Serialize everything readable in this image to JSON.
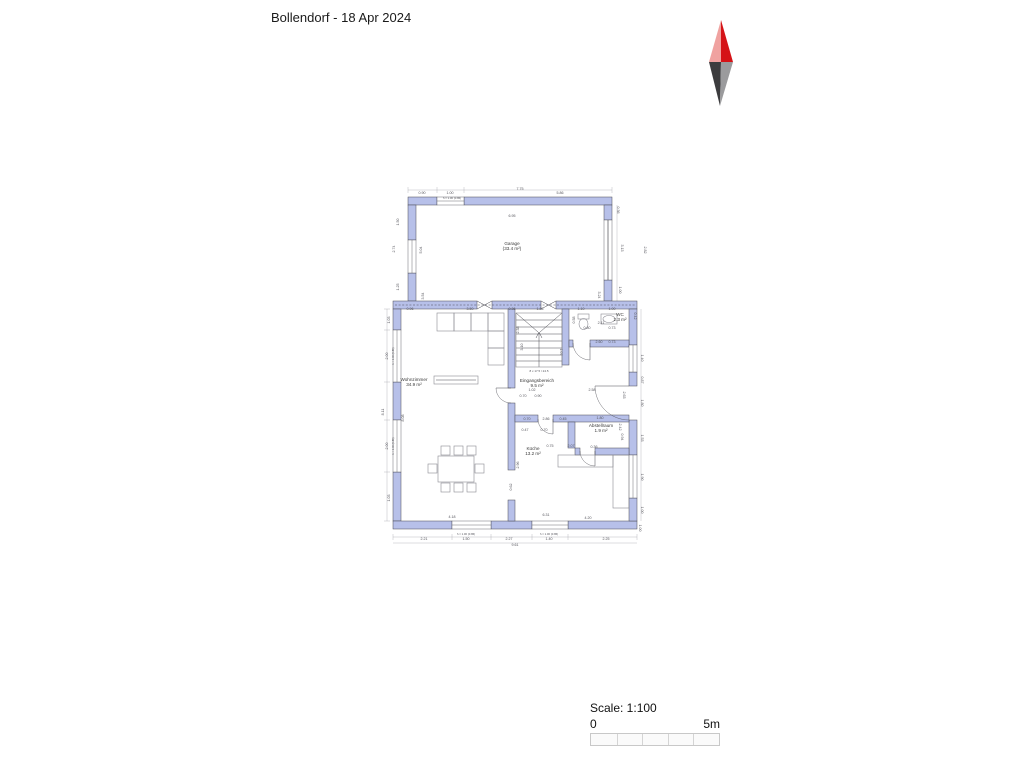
{
  "title": "Bollendorf - 18 Apr 2024",
  "scale": {
    "label": "Scale: 1:100",
    "start": "0",
    "end": "5m",
    "divisions": 5
  },
  "north_arrow": {
    "colors": {
      "nw": "#f0a2a0",
      "ne": "#d51317",
      "sw": "#3c3c3e",
      "se": "#9b9b9d"
    },
    "points": {
      "nw": "721,20 709,62 721,62",
      "ne": "721,20 733,62 721,62",
      "sw": "709,62 721,62 720,106",
      "se": "733,62 721,62 720,106"
    }
  },
  "colors": {
    "wall": "#b7c0e9",
    "outline": "#4a4a52",
    "dim": "#55555c",
    "guide": "#a8a8b0",
    "furniture": "#8a8a92"
  },
  "plan": {
    "walls": [
      {
        "x": 408,
        "y": 197,
        "w": 29,
        "h": 8
      },
      {
        "x": 464,
        "y": 197,
        "w": 148,
        "h": 8
      },
      {
        "x": 408,
        "y": 205,
        "w": 8,
        "h": 35
      },
      {
        "x": 408,
        "y": 273,
        "w": 8,
        "h": 28
      },
      {
        "x": 604,
        "y": 205,
        "w": 8,
        "h": 15
      },
      {
        "x": 604,
        "y": 280,
        "w": 8,
        "h": 21
      },
      {
        "x": 393,
        "y": 301,
        "w": 84,
        "h": 8
      },
      {
        "x": 492,
        "y": 301,
        "w": 49,
        "h": 8
      },
      {
        "x": 556,
        "y": 301,
        "w": 81,
        "h": 8
      },
      {
        "x": 393,
        "y": 309,
        "w": 8,
        "h": 21
      },
      {
        "x": 393,
        "y": 382,
        "w": 8,
        "h": 38
      },
      {
        "x": 393,
        "y": 472,
        "w": 8,
        "h": 49
      },
      {
        "x": 393,
        "y": 521,
        "w": 59,
        "h": 8
      },
      {
        "x": 491,
        "y": 521,
        "w": 41,
        "h": 8
      },
      {
        "x": 568,
        "y": 521,
        "w": 69,
        "h": 8
      },
      {
        "x": 629,
        "y": 309,
        "w": 8,
        "h": 36
      },
      {
        "x": 629,
        "y": 372,
        "w": 8,
        "h": 14
      },
      {
        "x": 629,
        "y": 420,
        "w": 8,
        "h": 35
      },
      {
        "x": 629,
        "y": 498,
        "w": 8,
        "h": 23
      },
      {
        "x": 508,
        "y": 309,
        "w": 7,
        "h": 79
      },
      {
        "x": 508,
        "y": 403,
        "w": 7,
        "h": 67
      },
      {
        "x": 508,
        "y": 500,
        "w": 7,
        "h": 21
      },
      {
        "x": 562,
        "y": 309,
        "w": 7,
        "h": 56
      },
      {
        "x": 569,
        "y": 340,
        "w": 4,
        "h": 7
      },
      {
        "x": 590,
        "y": 340,
        "w": 39,
        "h": 7
      },
      {
        "x": 515,
        "y": 415,
        "w": 23,
        "h": 7
      },
      {
        "x": 553,
        "y": 415,
        "w": 76,
        "h": 7
      },
      {
        "x": 568,
        "y": 422,
        "w": 7,
        "h": 26
      },
      {
        "x": 575,
        "y": 448,
        "w": 5,
        "h": 7
      },
      {
        "x": 595,
        "y": 448,
        "w": 34,
        "h": 7
      }
    ],
    "windows": [
      {
        "x": 437,
        "y": 197,
        "w": 27,
        "h": 8,
        "o": "h"
      },
      {
        "x": 408,
        "y": 240,
        "w": 8,
        "h": 33,
        "o": "v"
      },
      {
        "x": 604,
        "y": 220,
        "w": 8,
        "h": 60,
        "o": "v"
      },
      {
        "x": 393,
        "y": 330,
        "w": 8,
        "h": 52,
        "o": "v"
      },
      {
        "x": 393,
        "y": 420,
        "w": 8,
        "h": 52,
        "o": "v"
      },
      {
        "x": 629,
        "y": 345,
        "w": 8,
        "h": 27,
        "o": "v"
      },
      {
        "x": 629,
        "y": 455,
        "w": 8,
        "h": 43,
        "o": "v"
      },
      {
        "x": 452,
        "y": 521,
        "w": 39,
        "h": 8,
        "o": "h"
      },
      {
        "x": 532,
        "y": 521,
        "w": 36,
        "h": 8,
        "o": "h"
      }
    ],
    "lines": [
      {
        "x1": 477,
        "y1": 301,
        "x2": 492,
        "y2": 309
      },
      {
        "x1": 477,
        "y1": 309,
        "x2": 492,
        "y2": 301
      },
      {
        "x1": 541,
        "y1": 301,
        "x2": 556,
        "y2": 309
      },
      {
        "x1": 541,
        "y1": 309,
        "x2": 556,
        "y2": 301
      },
      {
        "x1": 395,
        "y1": 305,
        "x2": 635,
        "y2": 305,
        "dash": 1
      },
      {
        "x1": 608,
        "y1": 220,
        "x2": 608,
        "y2": 280
      },
      {
        "x1": 436,
        "y1": 380,
        "x2": 476,
        "y2": 380
      },
      {
        "x1": 516,
        "y1": 320,
        "x2": 562,
        "y2": 320
      },
      {
        "x1": 516,
        "y1": 327,
        "x2": 562,
        "y2": 327
      },
      {
        "x1": 516,
        "y1": 334,
        "x2": 562,
        "y2": 334
      },
      {
        "x1": 516,
        "y1": 341,
        "x2": 562,
        "y2": 341
      },
      {
        "x1": 516,
        "y1": 348,
        "x2": 562,
        "y2": 348
      },
      {
        "x1": 516,
        "y1": 355,
        "x2": 562,
        "y2": 355
      },
      {
        "x1": 516,
        "y1": 361,
        "x2": 562,
        "y2": 361
      },
      {
        "x1": 516,
        "y1": 313,
        "x2": 538,
        "y2": 332
      },
      {
        "x1": 562,
        "y1": 313,
        "x2": 540,
        "y2": 332
      },
      {
        "x1": 539,
        "y1": 367,
        "x2": 539,
        "y2": 332
      },
      {
        "x1": 536,
        "y1": 338,
        "x2": 539,
        "y2": 332
      },
      {
        "x1": 542,
        "y1": 338,
        "x2": 539,
        "y2": 332
      },
      {
        "x1": 629,
        "y1": 386,
        "x2": 595,
        "y2": 386
      },
      {
        "x1": 511,
        "y1": 388,
        "x2": 496,
        "y2": 388
      },
      {
        "x1": 590,
        "y1": 343,
        "x2": 590,
        "y2": 360
      },
      {
        "x1": 553,
        "y1": 419,
        "x2": 553,
        "y2": 434
      },
      {
        "x1": 595,
        "y1": 451,
        "x2": 595,
        "y2": 466
      }
    ],
    "guides": [
      {
        "x1": 408,
        "y1": 190,
        "x2": 612,
        "y2": 190
      },
      {
        "x1": 393,
        "y1": 537,
        "x2": 637,
        "y2": 537
      },
      {
        "x1": 393,
        "y1": 543,
        "x2": 637,
        "y2": 543
      },
      {
        "x1": 387,
        "y1": 309,
        "x2": 387,
        "y2": 521
      },
      {
        "x1": 617,
        "y1": 205,
        "x2": 617,
        "y2": 301
      },
      {
        "x1": 641,
        "y1": 309,
        "x2": 641,
        "y2": 521
      },
      {
        "x1": 408,
        "y1": 187,
        "x2": 408,
        "y2": 193
      },
      {
        "x1": 437,
        "y1": 187,
        "x2": 437,
        "y2": 193
      },
      {
        "x1": 464,
        "y1": 187,
        "x2": 464,
        "y2": 193
      },
      {
        "x1": 612,
        "y1": 187,
        "x2": 612,
        "y2": 193
      },
      {
        "x1": 393,
        "y1": 534,
        "x2": 393,
        "y2": 540
      },
      {
        "x1": 452,
        "y1": 534,
        "x2": 452,
        "y2": 540
      },
      {
        "x1": 491,
        "y1": 534,
        "x2": 491,
        "y2": 540
      },
      {
        "x1": 532,
        "y1": 534,
        "x2": 532,
        "y2": 540
      },
      {
        "x1": 568,
        "y1": 534,
        "x2": 568,
        "y2": 540
      },
      {
        "x1": 637,
        "y1": 534,
        "x2": 637,
        "y2": 540
      },
      {
        "x1": 384,
        "y1": 309,
        "x2": 390,
        "y2": 309
      },
      {
        "x1": 384,
        "y1": 330,
        "x2": 390,
        "y2": 330
      },
      {
        "x1": 384,
        "y1": 382,
        "x2": 390,
        "y2": 382
      },
      {
        "x1": 384,
        "y1": 420,
        "x2": 390,
        "y2": 420
      },
      {
        "x1": 384,
        "y1": 472,
        "x2": 390,
        "y2": 472
      },
      {
        "x1": 384,
        "y1": 521,
        "x2": 390,
        "y2": 521
      }
    ],
    "arcs": [
      {
        "d": "M595,386 A34 34 0 0 0 629,420"
      },
      {
        "d": "M496,388 A15 15 0 0 0 511,403"
      },
      {
        "d": "M573,343 A17 17 0 0 0 590,360"
      },
      {
        "d": "M538,419 A15 15 0 0 0 553,434"
      },
      {
        "d": "M580,451 A15 15 0 0 0 595,466"
      }
    ],
    "furniture": [
      {
        "x": 437,
        "y": 313,
        "w": 17,
        "h": 18
      },
      {
        "x": 454,
        "y": 313,
        "w": 17,
        "h": 18
      },
      {
        "x": 471,
        "y": 313,
        "w": 17,
        "h": 18
      },
      {
        "x": 488,
        "y": 313,
        "w": 16,
        "h": 18
      },
      {
        "x": 488,
        "y": 331,
        "w": 16,
        "h": 17
      },
      {
        "x": 488,
        "y": 348,
        "w": 16,
        "h": 17
      },
      {
        "x": 434,
        "y": 376,
        "w": 44,
        "h": 8
      },
      {
        "x": 438,
        "y": 456,
        "w": 36,
        "h": 26
      },
      {
        "x": 441,
        "y": 446,
        "w": 9,
        "h": 9
      },
      {
        "x": 454,
        "y": 446,
        "w": 9,
        "h": 9
      },
      {
        "x": 467,
        "y": 446,
        "w": 9,
        "h": 9
      },
      {
        "x": 441,
        "y": 483,
        "w": 9,
        "h": 9
      },
      {
        "x": 454,
        "y": 483,
        "w": 9,
        "h": 9
      },
      {
        "x": 467,
        "y": 483,
        "w": 9,
        "h": 9
      },
      {
        "x": 428,
        "y": 464,
        "w": 9,
        "h": 9
      },
      {
        "x": 475,
        "y": 464,
        "w": 9,
        "h": 9
      },
      {
        "x": 516,
        "y": 313,
        "w": 46,
        "h": 54
      },
      {
        "x": 613,
        "y": 455,
        "w": 16,
        "h": 53
      },
      {
        "x": 558,
        "y": 455,
        "w": 55,
        "h": 12
      },
      {
        "x": 578,
        "y": 314,
        "w": 11,
        "h": 5
      },
      {
        "x": 601,
        "y": 314,
        "w": 16,
        "h": 10
      }
    ],
    "ellipses": [
      {
        "cx": 583.5,
        "cy": 324,
        "rx": 4.5,
        "ry": 5.5
      },
      {
        "cx": 609,
        "cy": 319,
        "rx": 6,
        "ry": 3.5
      }
    ],
    "rooms": [
      {
        "name": "Garage",
        "area": "(33.4 m²)",
        "x": 512,
        "y": 245
      },
      {
        "name": "Wohnzimmer",
        "area": "34.9 m²",
        "x": 414,
        "y": 381
      },
      {
        "name": "Eingangsbereich",
        "area": "9.5 m²",
        "x": 537,
        "y": 382
      },
      {
        "name": "WC",
        "area": "2.3 m²",
        "x": 620,
        "y": 316
      },
      {
        "name": "Abstellraum",
        "area": "1.9 m²",
        "x": 601,
        "y": 427
      },
      {
        "name": "Küche",
        "area": "13.2 m²",
        "x": 533,
        "y": 450
      }
    ],
    "dims": [
      {
        "t": "0.90",
        "x": 422,
        "y": 194
      },
      {
        "t": "1.00",
        "x": 450,
        "y": 194
      },
      {
        "t": "7.75",
        "x": 520,
        "y": 190
      },
      {
        "t": "5.86",
        "x": 560,
        "y": 194
      },
      {
        "t": "h = 1.00 (0.86)",
        "x": 452,
        "y": 199,
        "s": 2.8
      },
      {
        "t": "6.95",
        "x": 512,
        "y": 217
      },
      {
        "t": "1.50",
        "x": 399,
        "y": 222,
        "r": -90
      },
      {
        "t": "2.74",
        "x": 395,
        "y": 249,
        "r": -90
      },
      {
        "t": "1.25",
        "x": 399,
        "y": 287,
        "r": -90
      },
      {
        "t": "5.04",
        "x": 422,
        "y": 250,
        "r": -90
      },
      {
        "t": "3.54",
        "x": 424,
        "y": 296,
        "r": -90
      },
      {
        "t": "0.36",
        "x": 617,
        "y": 210,
        "r": 90
      },
      {
        "t": "3.13",
        "x": 621,
        "y": 248,
        "r": 90
      },
      {
        "t": "1.00",
        "x": 619,
        "y": 290,
        "r": 90
      },
      {
        "t": "3.24",
        "x": 598,
        "y": 295,
        "r": 90
      },
      {
        "t": "2.82",
        "x": 644,
        "y": 250,
        "r": 90
      },
      {
        "t": "0.96",
        "x": 410,
        "y": 310
      },
      {
        "t": "3.50",
        "x": 470,
        "y": 310
      },
      {
        "t": "0.36",
        "x": 512,
        "y": 310
      },
      {
        "t": "1.86",
        "x": 540,
        "y": 310
      },
      {
        "t": "1.10",
        "x": 581,
        "y": 310
      },
      {
        "t": "1.00",
        "x": 612,
        "y": 310
      },
      {
        "t": "0.58",
        "x": 575,
        "y": 320,
        "r": -90
      },
      {
        "t": "0.80",
        "x": 587,
        "y": 329
      },
      {
        "t": "2.11",
        "x": 601,
        "y": 324
      },
      {
        "t": "0.73",
        "x": 612,
        "y": 329
      },
      {
        "t": "2.60",
        "x": 599,
        "y": 343
      },
      {
        "t": "0.73",
        "x": 612,
        "y": 343
      },
      {
        "t": "2.38",
        "x": 519,
        "y": 330,
        "r": -90
      },
      {
        "t": "3.10",
        "x": 523,
        "y": 347,
        "r": -90
      },
      {
        "t": "1.07",
        "x": 560,
        "y": 352,
        "r": 90
      },
      {
        "t": "8 x 17.5 / 24.5",
        "x": 539,
        "y": 372,
        "s": 3
      },
      {
        "t": "1.03",
        "x": 390,
        "y": 320,
        "r": -90
      },
      {
        "t": "2.00",
        "x": 388,
        "y": 356,
        "r": -90
      },
      {
        "t": "h = 1.00 (0.86)",
        "x": 394,
        "y": 356,
        "r": -90,
        "s": 2.6
      },
      {
        "t": "8.11",
        "x": 384,
        "y": 412,
        "r": -90
      },
      {
        "t": "2.00",
        "x": 388,
        "y": 446,
        "r": -90
      },
      {
        "t": "h = 1.00 (0.86)",
        "x": 394,
        "y": 446,
        "r": -90,
        "s": 2.6
      },
      {
        "t": "1.03",
        "x": 390,
        "y": 498,
        "r": -90
      },
      {
        "t": "8.08",
        "x": 404,
        "y": 418,
        "r": -90
      },
      {
        "t": "0.42",
        "x": 634,
        "y": 316,
        "r": 90
      },
      {
        "t": "1.40",
        "x": 641,
        "y": 358,
        "r": 90
      },
      {
        "t": "0.87",
        "x": 641,
        "y": 380,
        "r": 90
      },
      {
        "t": "1.80",
        "x": 641,
        "y": 403,
        "r": 90
      },
      {
        "t": "1.53",
        "x": 641,
        "y": 438,
        "r": 90
      },
      {
        "t": "1.90",
        "x": 641,
        "y": 477,
        "r": 90
      },
      {
        "t": "1.00",
        "x": 641,
        "y": 510,
        "r": 90
      },
      {
        "t": "2.63",
        "x": 623,
        "y": 395,
        "r": 90
      },
      {
        "t": "1.02",
        "x": 532,
        "y": 391
      },
      {
        "t": "0.70",
        "x": 523,
        "y": 397
      },
      {
        "t": "0.90",
        "x": 538,
        "y": 397
      },
      {
        "t": "2.58",
        "x": 592,
        "y": 391
      },
      {
        "t": "0.70",
        "x": 527,
        "y": 420
      },
      {
        "t": "2.86",
        "x": 546,
        "y": 420
      },
      {
        "t": "0.45",
        "x": 563,
        "y": 420
      },
      {
        "t": "1.80",
        "x": 600,
        "y": 419
      },
      {
        "t": "0.47",
        "x": 525,
        "y": 431
      },
      {
        "t": "0.70",
        "x": 544,
        "y": 431
      },
      {
        "t": "2.42",
        "x": 619,
        "y": 427,
        "r": 90
      },
      {
        "t": "0.94",
        "x": 621,
        "y": 437,
        "r": 90
      },
      {
        "t": "0.75",
        "x": 550,
        "y": 447
      },
      {
        "t": "2.07",
        "x": 571,
        "y": 447
      },
      {
        "t": "0.36",
        "x": 594,
        "y": 448
      },
      {
        "t": "2.96",
        "x": 519,
        "y": 465,
        "r": -90
      },
      {
        "t": "0.62",
        "x": 512,
        "y": 487,
        "r": -90
      },
      {
        "t": "4.18",
        "x": 452,
        "y": 518
      },
      {
        "t": "6.31",
        "x": 546,
        "y": 516
      },
      {
        "t": "4.20",
        "x": 588,
        "y": 519
      },
      {
        "t": "2.21",
        "x": 424,
        "y": 540
      },
      {
        "t": "h = 1.00 (0.86)",
        "x": 466,
        "y": 535,
        "s": 2.8
      },
      {
        "t": "1.50",
        "x": 466,
        "y": 540
      },
      {
        "t": "2.27",
        "x": 509,
        "y": 540
      },
      {
        "t": "9.61",
        "x": 515,
        "y": 546
      },
      {
        "t": "h = 1.00 (0.86)",
        "x": 549,
        "y": 535,
        "s": 2.8
      },
      {
        "t": "1.40",
        "x": 549,
        "y": 540
      },
      {
        "t": "2.25",
        "x": 606,
        "y": 540
      },
      {
        "t": "1.00",
        "x": 639,
        "y": 528,
        "r": 90
      }
    ]
  }
}
